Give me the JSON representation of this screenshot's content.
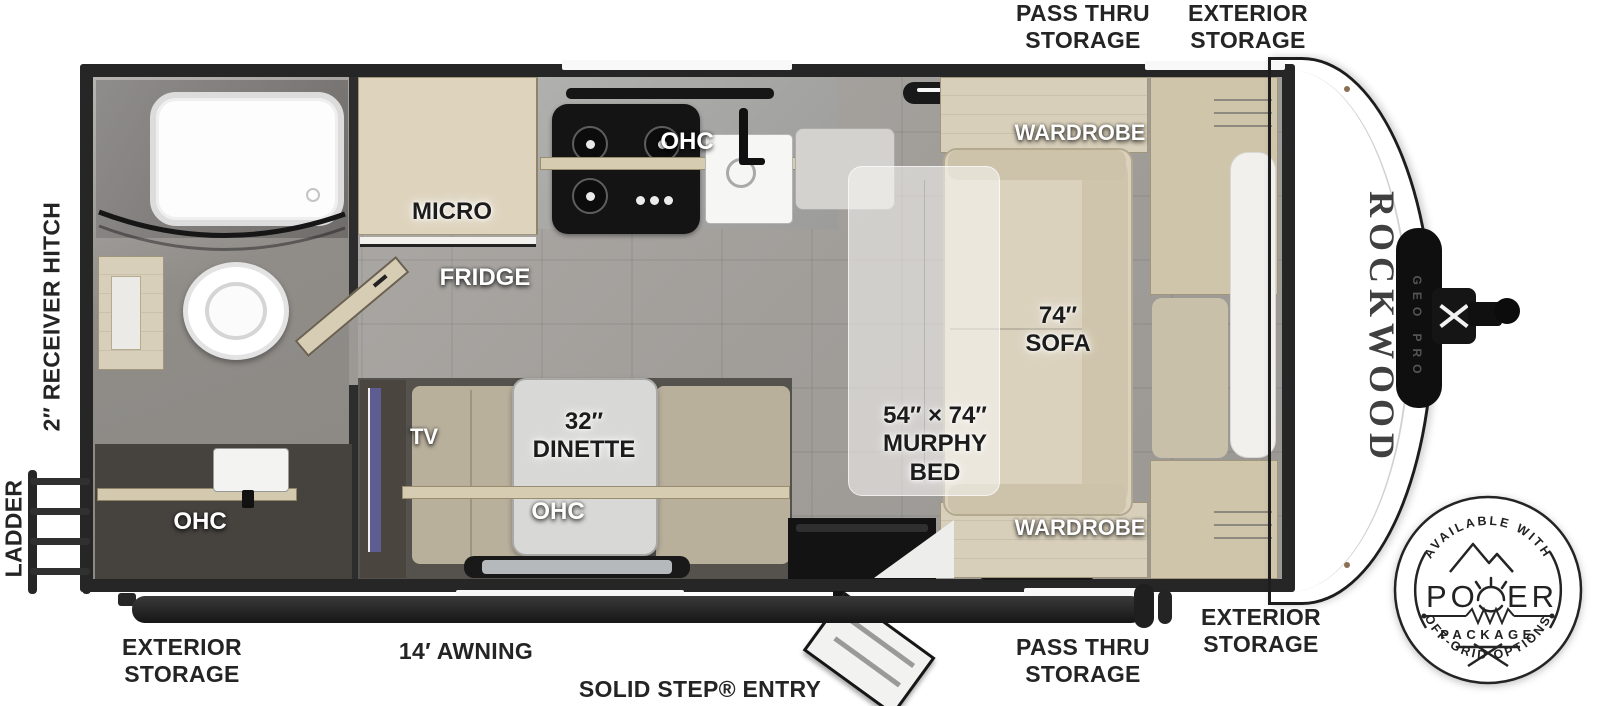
{
  "branding": {
    "name": "ROCKWOOD",
    "model": "GEO PRO"
  },
  "exterior": {
    "top_pass_thru_storage": "PASS THRU STORAGE",
    "top_exterior_storage": "EXTERIOR STORAGE",
    "receiver_hitch": "2″ RECEIVER HITCH",
    "ladder": "LADDER",
    "bottom_exterior_storage_left": "EXTERIOR STORAGE",
    "awning": "14′ AWNING",
    "entry": "SOLID STEP® ENTRY",
    "bottom_pass_thru_storage": "PASS THRU STORAGE",
    "bottom_exterior_storage_right": "EXTERIOR STORAGE"
  },
  "interior": {
    "bath_ohc": "OHC",
    "micro": "MICRO",
    "fridge": "FRIDGE",
    "kitchen_ohc": "OHC",
    "wardrobe_top": "WARDROBE",
    "wardrobe_bottom": "WARDROBE",
    "sofa_lines": [
      "74″",
      "SOFA"
    ],
    "murphy_bed_lines": [
      "54″ × 74″",
      "MURPHY",
      "BED"
    ],
    "tv": "TV",
    "dinette_lines": [
      "32″",
      "DINETTE"
    ],
    "dinette_ohc": "OHC"
  },
  "badge": {
    "arc_top": "AVAILABLE WITH",
    "power_left": "PO",
    "power_right": "ER",
    "package": "PACKAGE",
    "arc_bottom": "OFF-GRID OPTIONS"
  },
  "colors": {
    "wall": "#262626",
    "floor": "#a8a5a1",
    "wood": "#d8cfba",
    "cushion": "#d9d0bc",
    "label_dark": "#1c1c1c",
    "label_white": "#ffffff",
    "badge_ink": "#222222",
    "tv_accent": "#5d5d91"
  }
}
